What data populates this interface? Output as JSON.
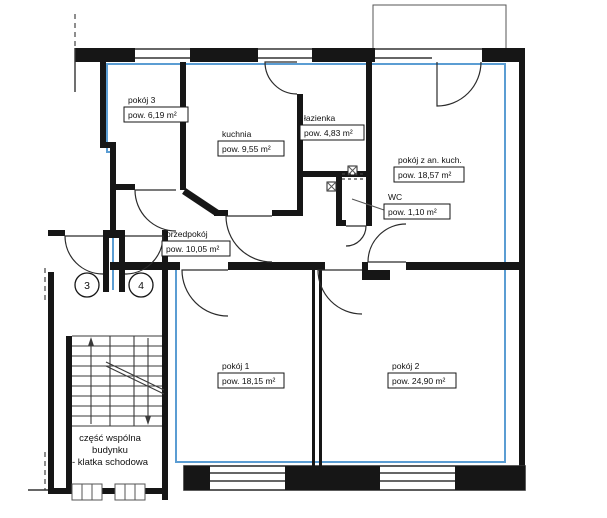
{
  "plan_title": "apartment floor plan",
  "rooms": [
    {
      "id": "pokoj-3",
      "name": "pokój 3",
      "area": "pow. 6,19 m²"
    },
    {
      "id": "kuchnia",
      "name": "kuchnia",
      "area": "pow. 9,55 m²"
    },
    {
      "id": "lazienka",
      "name": "łazienka",
      "area": "pow. 4,83 m²"
    },
    {
      "id": "pokoj-z-an-kuch",
      "name": "pokój z an. kuch.",
      "area": "pow. 18,57 m²"
    },
    {
      "id": "wc",
      "name": "WC",
      "area": "pow. 1,10 m²"
    },
    {
      "id": "przedpokoj",
      "name": "przedpokój",
      "area": "pow. 10,05 m²"
    },
    {
      "id": "pokoj-1",
      "name": "pokój 1",
      "area": "pow. 18,15 m²"
    },
    {
      "id": "pokoj-2",
      "name": "pokój 2",
      "area": "pow. 24,90 m²"
    }
  ],
  "staircase": {
    "label_line1": "część wspólna",
    "label_line2": "budynku",
    "label_line3": "- klatka schodowa"
  },
  "unit_markers": [
    {
      "label": "3"
    },
    {
      "label": "4"
    }
  ],
  "colors": {
    "wall": "#161616",
    "unit_boundary_blue": "#5b9dd3",
    "background": "#ffffff"
  }
}
